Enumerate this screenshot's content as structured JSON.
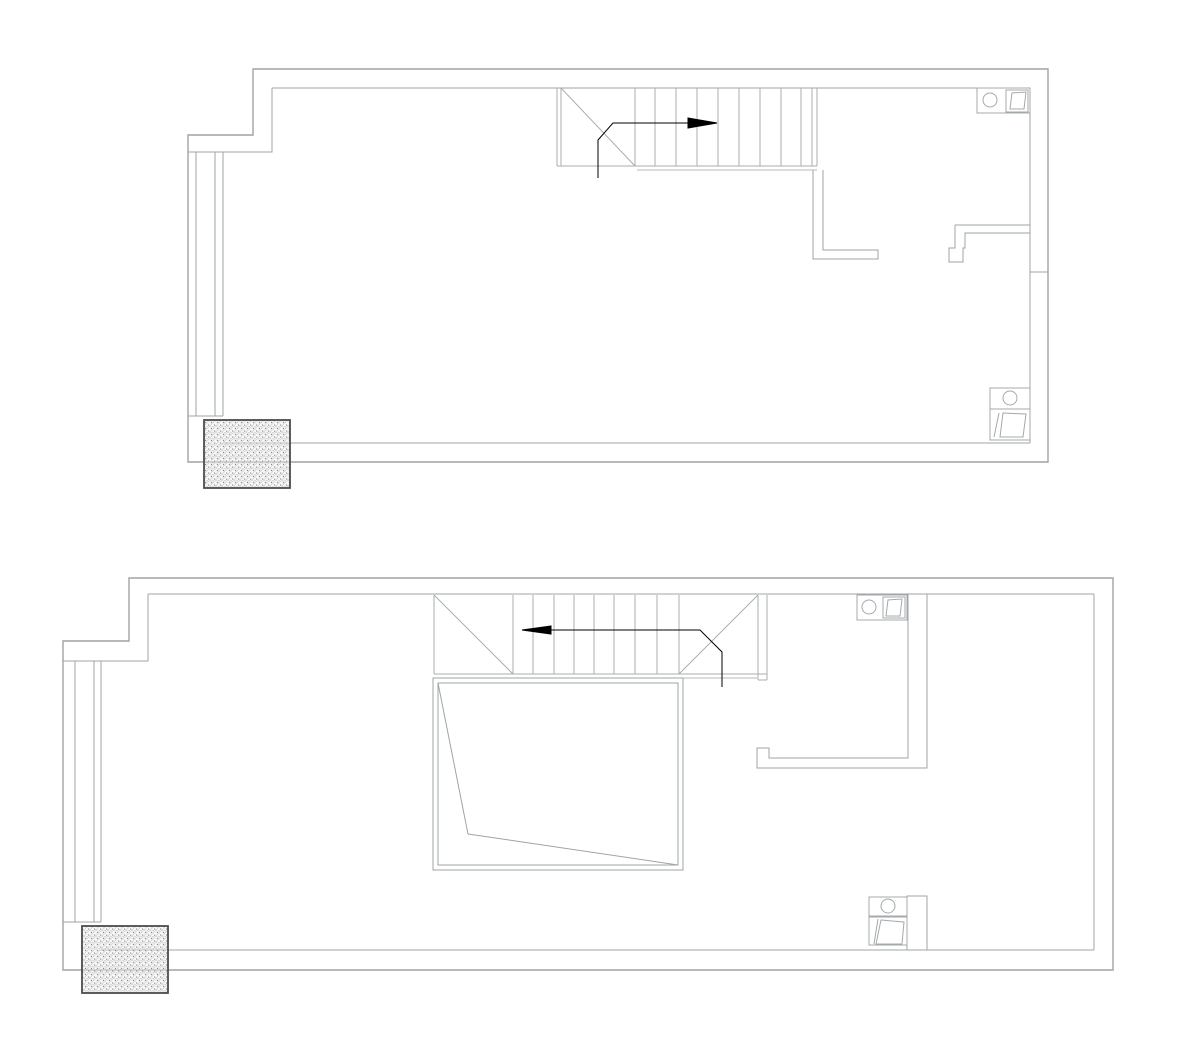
{
  "document": {
    "title": "Two-level apartment CAD floor plan (no text labels visible)",
    "background": "#ffffff"
  },
  "colors": {
    "wall": "#9fa4a7",
    "stair": "#a9aeb0",
    "thin": "#b5babc",
    "fixture": "#a4a9ac",
    "void": "#9fa4a7",
    "arrow": "#000000",
    "hatch_border": "#4c4c4c",
    "hatch_line": "#d4d4d2",
    "hatch_dot": "#8a8f91",
    "hatch_bg": "#efefee"
  },
  "plans": [
    {
      "id": "upper-floor-plan",
      "label": "upper level",
      "elements": [
        {
          "name": "outer-wall",
          "type": "polygon",
          "points": [
            [
              253,
              69
            ],
            [
              1048,
              69
            ],
            [
              1048,
              462
            ],
            [
              188,
              462
            ],
            [
              188,
              135
            ],
            [
              253,
              135
            ]
          ],
          "stroke": "wall",
          "sw": 1.4,
          "fill": "none"
        },
        {
          "name": "inner-wall-top",
          "type": "line",
          "x1": 272,
          "y1": 88,
          "x2": 1030,
          "y2": 88,
          "stroke": "wall"
        },
        {
          "name": "inner-wall-right",
          "type": "line",
          "x1": 1030,
          "y1": 88,
          "x2": 1030,
          "y2": 443,
          "stroke": "wall"
        },
        {
          "name": "inner-wall-bottom",
          "type": "line",
          "x1": 1030,
          "y1": 443,
          "x2": 223,
          "y2": 443,
          "stroke": "wall"
        },
        {
          "name": "inner-wall-step",
          "type": "polyline",
          "points": [
            [
              272,
              88
            ],
            [
              272,
              152
            ],
            [
              188,
              152
            ]
          ],
          "stroke": "wall"
        },
        {
          "name": "window-bay-lines",
          "type": "vlines",
          "xs": [
            196,
            215,
            223
          ],
          "y1": 152,
          "y2": 416,
          "stroke": "wall"
        },
        {
          "name": "window-sill",
          "type": "line",
          "x1": 188,
          "y1": 416,
          "x2": 223,
          "y2": 416,
          "stroke": "wall"
        },
        {
          "name": "stair-left-edge",
          "type": "vlines",
          "xs": [
            557,
            561
          ],
          "y1": 88,
          "y2": 166,
          "stroke": "stair"
        },
        {
          "name": "stair-bottom-edge",
          "type": "line",
          "x1": 557,
          "y1": 166,
          "x2": 817,
          "y2": 166,
          "stroke": "stair"
        },
        {
          "name": "stair-landing-diagonal",
          "type": "line",
          "x1": 561,
          "y1": 88,
          "x2": 635,
          "y2": 166,
          "stroke": "stair"
        },
        {
          "name": "stair-treads",
          "type": "vlines",
          "xs": [
            635,
            655,
            676,
            697,
            718,
            739,
            760,
            781,
            801
          ],
          "y1": 88,
          "y2": 166,
          "stroke": "stair"
        },
        {
          "name": "stair-right-edge",
          "type": "vlines",
          "xs": [
            812,
            817
          ],
          "y1": 88,
          "y2": 166,
          "stroke": "stair"
        },
        {
          "name": "floor-opening-edge",
          "type": "line",
          "x1": 637,
          "y1": 170,
          "x2": 817,
          "y2": 170,
          "stroke": "thin"
        },
        {
          "name": "stair-direction-line",
          "type": "polyline",
          "points": [
            [
              598,
              178
            ],
            [
              598,
              140
            ],
            [
              613,
              123
            ],
            [
              690,
              123
            ]
          ],
          "stroke": "arrow",
          "sw": 1
        },
        {
          "name": "stair-direction-arrowhead",
          "type": "polygon",
          "points": [
            [
              688,
              118
            ],
            [
              717,
              123
            ],
            [
              688,
              128
            ]
          ],
          "fill": "arrow",
          "stroke": "arrow"
        },
        {
          "name": "bathroom-wall-left",
          "type": "polyline",
          "points": [
            [
              813,
              170
            ],
            [
              813,
              259
            ],
            [
              878,
              259
            ],
            [
              878,
              250
            ],
            [
              823,
              250
            ],
            [
              823,
              170
            ]
          ],
          "stroke": "wall"
        },
        {
          "name": "bathroom-door-header",
          "type": "line",
          "x1": 955,
          "y1": 225,
          "x2": 1030,
          "y2": 225,
          "stroke": "wall"
        },
        {
          "name": "bathroom-door-jamb",
          "type": "polyline",
          "points": [
            [
              955,
              225
            ],
            [
              955,
              248
            ],
            [
              949,
              248
            ],
            [
              949,
              262
            ],
            [
              963,
              262
            ],
            [
              963,
              248
            ],
            [
              965,
              248
            ],
            [
              965,
              233
            ],
            [
              1030,
              233
            ]
          ],
          "stroke": "wall"
        },
        {
          "name": "wall-return-tick",
          "type": "line",
          "x1": 1030,
          "y1": 272,
          "x2": 1048,
          "y2": 272,
          "stroke": "wall"
        },
        {
          "name": "sink-counter",
          "type": "rect",
          "x": 977,
          "y": 88,
          "w": 53,
          "h": 25,
          "stroke": "fixture"
        },
        {
          "name": "sink-circle",
          "type": "circle",
          "cx": 990,
          "cy": 100,
          "r": 7,
          "stroke": "fixture"
        },
        {
          "name": "washer-box",
          "type": "rect",
          "x": 1006,
          "y": 90,
          "w": 22,
          "h": 22,
          "stroke": "fixture"
        },
        {
          "name": "washer-symbol",
          "type": "polygon",
          "points": [
            [
              1010,
              109
            ],
            [
              1012,
              93
            ],
            [
              1026,
              92
            ],
            [
              1024,
              109
            ]
          ],
          "fill": "none",
          "stroke": "fixture"
        },
        {
          "name": "wc-unit-box",
          "type": "rect",
          "x": 990,
          "y": 388,
          "w": 40,
          "h": 52,
          "stroke": "fixture"
        },
        {
          "name": "wc-unit-divider",
          "type": "line",
          "x1": 990,
          "y1": 409,
          "x2": 1030,
          "y2": 409,
          "stroke": "fixture"
        },
        {
          "name": "wc-circle",
          "type": "circle",
          "cx": 1010,
          "cy": 398,
          "r": 7,
          "stroke": "fixture"
        },
        {
          "name": "wc-symbol",
          "type": "polygon",
          "points": [
            [
              1003,
              413
            ],
            [
              1026,
              414
            ],
            [
              1023,
              437
            ],
            [
              1000,
              437
            ]
          ],
          "fill": "none",
          "stroke": "fixture"
        },
        {
          "name": "wc-symbol-strip",
          "type": "polyline",
          "points": [
            [
              999,
              413
            ],
            [
              994,
              437
            ]
          ],
          "stroke": "fixture"
        },
        {
          "name": "column-hatch",
          "type": "hatch",
          "x": 204,
          "y": 420,
          "w": 86,
          "h": 68
        }
      ]
    },
    {
      "id": "lower-floor-plan",
      "label": "lower level",
      "elements": [
        {
          "name": "outer-wall",
          "type": "polygon",
          "points": [
            [
              129,
              578
            ],
            [
              1113,
              578
            ],
            [
              1113,
              970
            ],
            [
              63,
              970
            ],
            [
              63,
              641
            ],
            [
              129,
              641
            ]
          ],
          "stroke": "wall",
          "sw": 1.4,
          "fill": "none"
        },
        {
          "name": "inner-wall-top",
          "type": "line",
          "x1": 148,
          "y1": 594,
          "x2": 1094,
          "y2": 594,
          "stroke": "wall"
        },
        {
          "name": "inner-wall-right",
          "type": "line",
          "x1": 1094,
          "y1": 594,
          "x2": 1094,
          "y2": 950,
          "stroke": "wall"
        },
        {
          "name": "inner-wall-bottom",
          "type": "line",
          "x1": 1094,
          "y1": 950,
          "x2": 101,
          "y2": 950,
          "stroke": "wall"
        },
        {
          "name": "inner-wall-step",
          "type": "polyline",
          "points": [
            [
              148,
              594
            ],
            [
              148,
              661
            ],
            [
              63,
              661
            ]
          ],
          "stroke": "wall"
        },
        {
          "name": "window-bay-lines",
          "type": "vlines",
          "xs": [
            75,
            94,
            101
          ],
          "y1": 661,
          "y2": 922,
          "stroke": "wall"
        },
        {
          "name": "window-sill",
          "type": "line",
          "x1": 63,
          "y1": 922,
          "x2": 101,
          "y2": 922,
          "stroke": "wall"
        },
        {
          "name": "stair-left-edge",
          "type": "line",
          "x1": 434,
          "y1": 595,
          "x2": 434,
          "y2": 674,
          "stroke": "stair"
        },
        {
          "name": "stair-bottom-edge",
          "type": "line",
          "x1": 434,
          "y1": 674,
          "x2": 767,
          "y2": 674,
          "stroke": "stair"
        },
        {
          "name": "stair-winder-left",
          "type": "line",
          "x1": 434,
          "y1": 595,
          "x2": 513,
          "y2": 674,
          "stroke": "stair"
        },
        {
          "name": "stair-winder-right",
          "type": "line",
          "x1": 679,
          "y1": 674,
          "x2": 758,
          "y2": 595,
          "stroke": "stair"
        },
        {
          "name": "stair-treads",
          "type": "vlines",
          "xs": [
            513,
            533,
            554,
            574,
            594,
            614,
            635,
            657,
            679
          ],
          "y1": 595,
          "y2": 674,
          "stroke": "stair"
        },
        {
          "name": "stair-right-edge",
          "type": "vlines",
          "xs": [
            758,
            767
          ],
          "y1": 595,
          "y2": 680,
          "stroke": "stair"
        },
        {
          "name": "stair-right-edge-cap",
          "type": "line",
          "x1": 758,
          "y1": 680,
          "x2": 767,
          "y2": 680,
          "stroke": "stair"
        },
        {
          "name": "floor-edge",
          "type": "line",
          "x1": 683,
          "y1": 678,
          "x2": 757,
          "y2": 678,
          "stroke": "thin"
        },
        {
          "name": "stair-direction-line",
          "type": "polyline",
          "points": [
            [
              550,
              630
            ],
            [
              700,
              630
            ],
            [
              722,
              652
            ],
            [
              722,
              687
            ]
          ],
          "stroke": "arrow",
          "sw": 1
        },
        {
          "name": "stair-direction-arrowhead",
          "type": "polygon",
          "points": [
            [
              551,
              626
            ],
            [
              522,
              630
            ],
            [
              551,
              634
            ]
          ],
          "fill": "arrow",
          "stroke": "arrow"
        },
        {
          "name": "void-opening-outer",
          "type": "rect",
          "x": 433,
          "y": 678,
          "w": 250,
          "h": 192,
          "stroke": "void"
        },
        {
          "name": "void-opening-inner",
          "type": "rect",
          "x": 438,
          "y": 683,
          "w": 240,
          "h": 182,
          "stroke": "void"
        },
        {
          "name": "void-diagonal-1",
          "type": "line",
          "x1": 438,
          "y1": 683,
          "x2": 468,
          "y2": 834,
          "stroke": "void"
        },
        {
          "name": "void-diagonal-2",
          "type": "line",
          "x1": 468,
          "y1": 834,
          "x2": 678,
          "y2": 865,
          "stroke": "void"
        },
        {
          "name": "partition-wall",
          "type": "polyline",
          "points": [
            [
              908,
              594
            ],
            [
              908,
              758
            ],
            [
              769,
              758
            ],
            [
              769,
              748
            ],
            [
              757,
              748
            ],
            [
              757,
              768
            ],
            [
              927,
              768
            ],
            [
              927,
              594
            ]
          ],
          "stroke": "wall"
        },
        {
          "name": "partition-stub",
          "type": "polyline",
          "points": [
            [
              907,
              950
            ],
            [
              907,
              896
            ],
            [
              927,
              896
            ],
            [
              927,
              950
            ]
          ],
          "stroke": "wall"
        },
        {
          "name": "sink-counter",
          "type": "rect",
          "x": 857,
          "y": 595,
          "w": 50,
          "h": 25,
          "stroke": "fixture"
        },
        {
          "name": "sink-circle",
          "type": "circle",
          "cx": 869,
          "cy": 607,
          "r": 7,
          "stroke": "fixture"
        },
        {
          "name": "washer-box",
          "type": "rect",
          "x": 883,
          "y": 597,
          "w": 22,
          "h": 21,
          "stroke": "fixture"
        },
        {
          "name": "washer-symbol",
          "type": "polygon",
          "points": [
            [
              886,
              616
            ],
            [
              888,
              600
            ],
            [
              902,
              599
            ],
            [
              900,
              616
            ]
          ],
          "fill": "none",
          "stroke": "fixture"
        },
        {
          "name": "basin-box",
          "type": "rect",
          "x": 869,
          "y": 897,
          "w": 38,
          "h": 19,
          "stroke": "fixture"
        },
        {
          "name": "basin-circle",
          "type": "circle",
          "cx": 888,
          "cy": 906,
          "r": 7,
          "stroke": "fixture"
        },
        {
          "name": "appliance-box",
          "type": "rect",
          "x": 869,
          "y": 917,
          "w": 38,
          "h": 28,
          "stroke": "fixture"
        },
        {
          "name": "appliance-symbol",
          "type": "polygon",
          "points": [
            [
              881,
              920
            ],
            [
              904,
              922
            ],
            [
              902,
              944
            ],
            [
              876,
              944
            ]
          ],
          "fill": "none",
          "stroke": "fixture"
        },
        {
          "name": "appliance-symbol-strip",
          "type": "polyline",
          "points": [
            [
              878,
              919
            ],
            [
              874,
              944
            ]
          ],
          "stroke": "fixture"
        },
        {
          "name": "column-hatch",
          "type": "hatch",
          "x": 82,
          "y": 926,
          "w": 86,
          "h": 67
        }
      ]
    }
  ]
}
